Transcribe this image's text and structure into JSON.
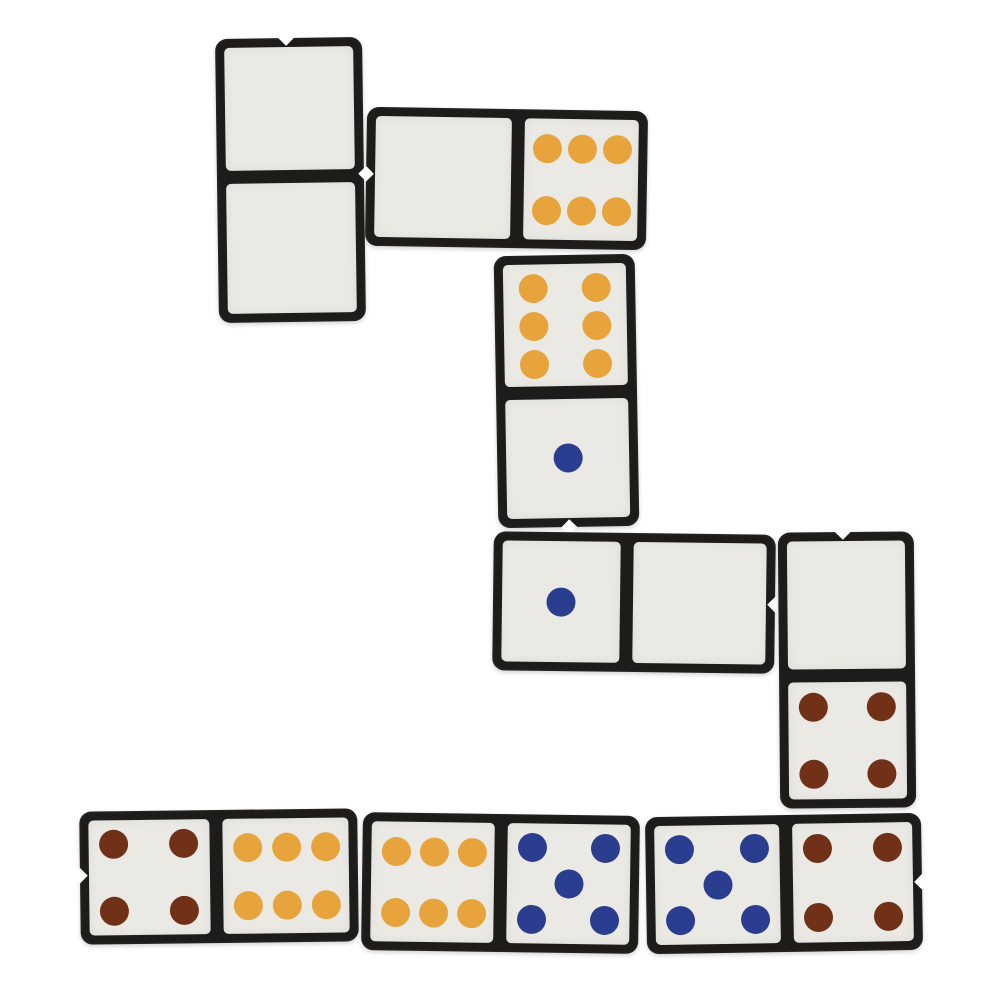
{
  "scene": {
    "description": "Photograph-style layout of eight black dominoes with off-white faces and colored pips, arranged as a connected domino chain on a plain white background",
    "background_color": "#ffffff",
    "tile_color": "#1d1c1a",
    "face_color": "#eae9e4",
    "divider_color": "#1f1d19",
    "pip_colors": {
      "orange": "#e8a43c",
      "blue": "#2a3d8e",
      "brown": "#713119"
    }
  },
  "tile_style": {
    "margin": 9,
    "gap": 6.5,
    "pip_size": 29,
    "tile_radius": 12,
    "face_radius": 5
  },
  "pip_layouts": {
    "0": [],
    "1": [
      [
        0.5,
        0.5
      ]
    ],
    "4": [
      [
        0.21,
        0.21
      ],
      [
        0.79,
        0.21
      ],
      [
        0.21,
        0.79
      ],
      [
        0.79,
        0.79
      ]
    ],
    "5": [
      [
        0.2,
        0.2
      ],
      [
        0.8,
        0.2
      ],
      [
        0.5,
        0.5
      ],
      [
        0.2,
        0.8
      ],
      [
        0.8,
        0.8
      ]
    ],
    "6": {
      "v": [
        [
          0.24,
          0.2
        ],
        [
          0.76,
          0.2
        ],
        [
          0.24,
          0.51
        ],
        [
          0.76,
          0.51
        ],
        [
          0.24,
          0.82
        ],
        [
          0.76,
          0.82
        ]
      ],
      "h": [
        [
          0.2,
          0.25
        ],
        [
          0.51,
          0.25
        ],
        [
          0.82,
          0.25
        ],
        [
          0.2,
          0.76
        ],
        [
          0.51,
          0.76
        ],
        [
          0.82,
          0.76
        ]
      ]
    }
  },
  "dominoes": [
    {
      "id": "domino-double-blank",
      "label": "blank-blank",
      "orientation": "vertical",
      "x": 217,
      "y": 38,
      "width": 147,
      "height": 284,
      "rotation": -0.8,
      "split": 0.486,
      "notch": "top",
      "halves": [
        {
          "pips": 0,
          "color": null
        },
        {
          "pips": 0,
          "color": null
        }
      ]
    },
    {
      "id": "domino-blank-six",
      "label": "blank-six",
      "orientation": "horizontal",
      "x": 366,
      "y": 109,
      "width": 281,
      "height": 139,
      "rotation": 0.9,
      "split": 0.538,
      "notch": "left",
      "halves": [
        {
          "pips": 0,
          "color": null
        },
        {
          "pips": 6,
          "color": "orange"
        }
      ]
    },
    {
      "id": "domino-six-one",
      "label": "six-one",
      "orientation": "vertical",
      "x": 496,
      "y": 255,
      "width": 141,
      "height": 272,
      "rotation": -1.0,
      "split": 0.505,
      "notch": "bottom",
      "halves": [
        {
          "pips": 6,
          "color": "orange"
        },
        {
          "pips": 1,
          "color": "blue"
        }
      ]
    },
    {
      "id": "domino-one-blank",
      "label": "one-blank",
      "orientation": "horizontal",
      "x": 493,
      "y": 533,
      "width": 282,
      "height": 139,
      "rotation": 0.7,
      "split": 0.475,
      "notch": "right",
      "halves": [
        {
          "pips": 1,
          "color": "blue"
        },
        {
          "pips": 0,
          "color": null
        }
      ]
    },
    {
      "id": "domino-blank-four",
      "label": "blank-four",
      "orientation": "vertical",
      "x": 779,
      "y": 532,
      "width": 136,
      "height": 276,
      "rotation": -0.5,
      "split": 0.52,
      "notch": "top",
      "halves": [
        {
          "pips": 0,
          "color": null
        },
        {
          "pips": 4,
          "color": "brown"
        }
      ]
    },
    {
      "id": "domino-four-six",
      "label": "four-six",
      "orientation": "horizontal",
      "x": 80,
      "y": 810,
      "width": 278,
      "height": 133,
      "rotation": -0.7,
      "split": 0.49,
      "notch": "left",
      "halves": [
        {
          "pips": 4,
          "color": "brown"
        },
        {
          "pips": 6,
          "color": "orange"
        }
      ]
    },
    {
      "id": "domino-six-five",
      "label": "six-five",
      "orientation": "horizontal",
      "x": 362,
      "y": 814,
      "width": 277,
      "height": 138,
      "rotation": 0.8,
      "split": 0.5,
      "notch": null,
      "halves": [
        {
          "pips": 6,
          "color": "orange"
        },
        {
          "pips": 5,
          "color": "blue"
        }
      ]
    },
    {
      "id": "domino-five-four",
      "label": "five-four",
      "orientation": "horizontal",
      "x": 646,
      "y": 815,
      "width": 276,
      "height": 137,
      "rotation": -0.9,
      "split": 0.51,
      "notch": "right",
      "halves": [
        {
          "pips": 5,
          "color": "blue"
        },
        {
          "pips": 4,
          "color": "brown"
        }
      ]
    }
  ]
}
